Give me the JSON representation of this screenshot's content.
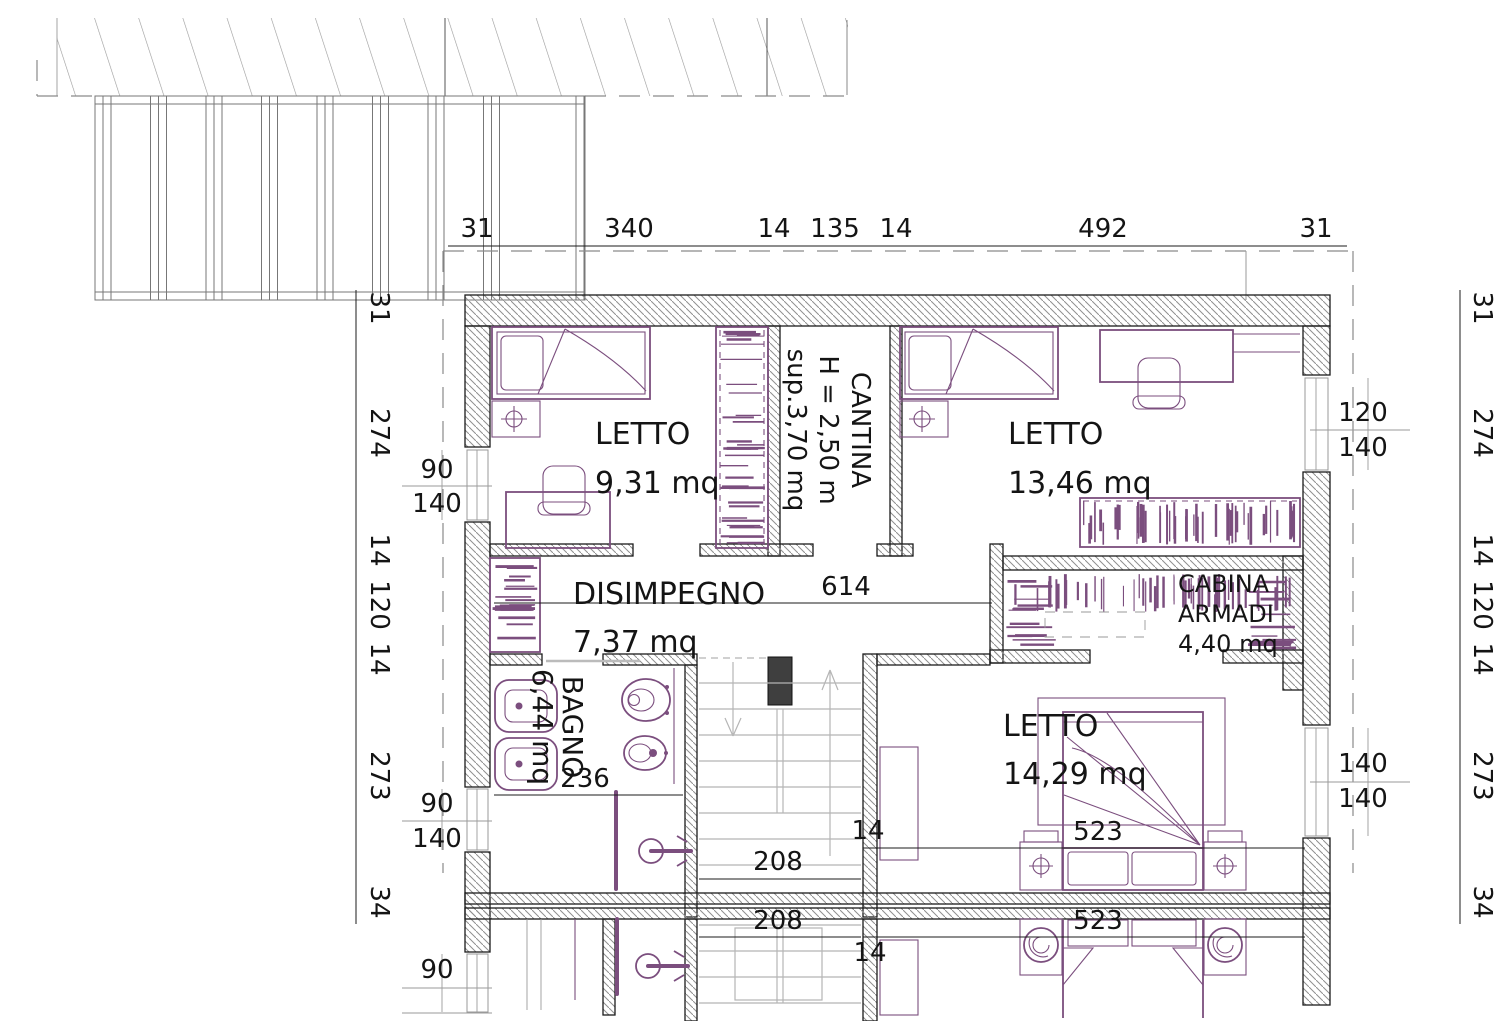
{
  "drawing": {
    "rooms": {
      "letto1": {
        "name": "LETTO",
        "area": "9,31 mq"
      },
      "letto2": {
        "name": "LETTO",
        "area": "13,46 mq"
      },
      "letto3": {
        "name": "LETTO",
        "area": "14,29 mq"
      },
      "disimpegno": {
        "name": "DISIMPEGNO",
        "area": "7,37 mq"
      },
      "bagno": {
        "name": "BAGNO",
        "area": "6,44 mq"
      },
      "cabina_armadi": {
        "name_line1": "CABINA",
        "name_line2": "ARMADI",
        "area": "4,40 mq"
      },
      "cantina": {
        "name": "CANTINA",
        "height": "H = 2,50 m",
        "surface": "sup.3,70 mq"
      }
    },
    "dims": {
      "top": [
        "31",
        "340",
        "14",
        "135",
        "14",
        "492",
        "31"
      ],
      "left": [
        "31",
        "274",
        "14",
        "120",
        "14",
        "273",
        "34"
      ],
      "right": [
        "31",
        "274",
        "14",
        "120",
        "14",
        "273",
        "34"
      ],
      "hall_width": "614",
      "bagno_width": "236",
      "stair_width": "208",
      "stair_wall": "14",
      "letto3_width": "523",
      "lower_stair_width": "208",
      "lower_wall": "14",
      "lower_letto_width": "523"
    },
    "windows": {
      "left_upper": [
        "90",
        "140"
      ],
      "left_lower": [
        "90",
        "140"
      ],
      "left_bottom": "90",
      "right_upper": [
        "120",
        "140"
      ],
      "right_lower": [
        "140",
        "140"
      ]
    },
    "colors": {
      "furniture": "#7b4e7e",
      "wall_hatch": "#8f8f8f",
      "stairs_gray": "#b5b5b5",
      "dash_gray": "#8a8a8a",
      "text": "#141414"
    }
  }
}
